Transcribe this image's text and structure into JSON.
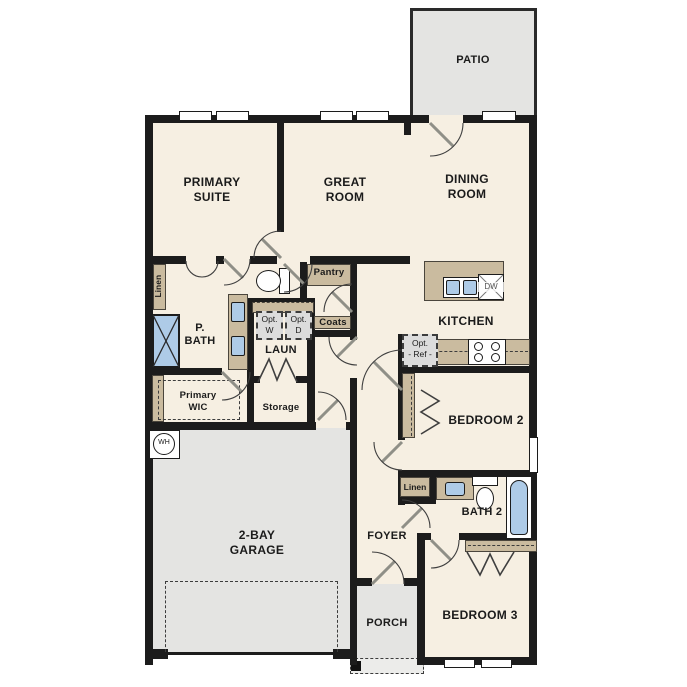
{
  "rooms": {
    "patio": "PATIO",
    "primary_suite": "PRIMARY\nSUITE",
    "great_room": "GREAT\nROOM",
    "dining_room": "DINING\nROOM",
    "kitchen": "KITCHEN",
    "primary_bath": "P.\nBATH",
    "laundry": "LAUN",
    "pantry": "Pantry",
    "coats": "Coats",
    "primary_wic": "Primary\nWIC",
    "storage": "Storage",
    "linen_bath": "Linen",
    "linen_hall": "Linen",
    "bath2": "BATH 2",
    "bedroom2": "BEDROOM 2",
    "bedroom3": "BEDROOM 3",
    "foyer": "FOYER",
    "porch": "PORCH",
    "garage": "2-BAY\nGARAGE"
  },
  "fixtures": {
    "water_heater": "WH",
    "dishwasher": "DW",
    "opt_washer": "Opt.\nW",
    "opt_dryer": "Opt.\nD",
    "opt_refrigerator": "Opt.\n- Ref -"
  },
  "colors": {
    "floor": "#f6efe2",
    "wall": "#1c1c1c",
    "cabinet_tan": "#cabb9f",
    "concrete_gray": "#e4e4e2",
    "fixture_blue": "#aecbe7",
    "option_gray": "#dcdcdc"
  }
}
